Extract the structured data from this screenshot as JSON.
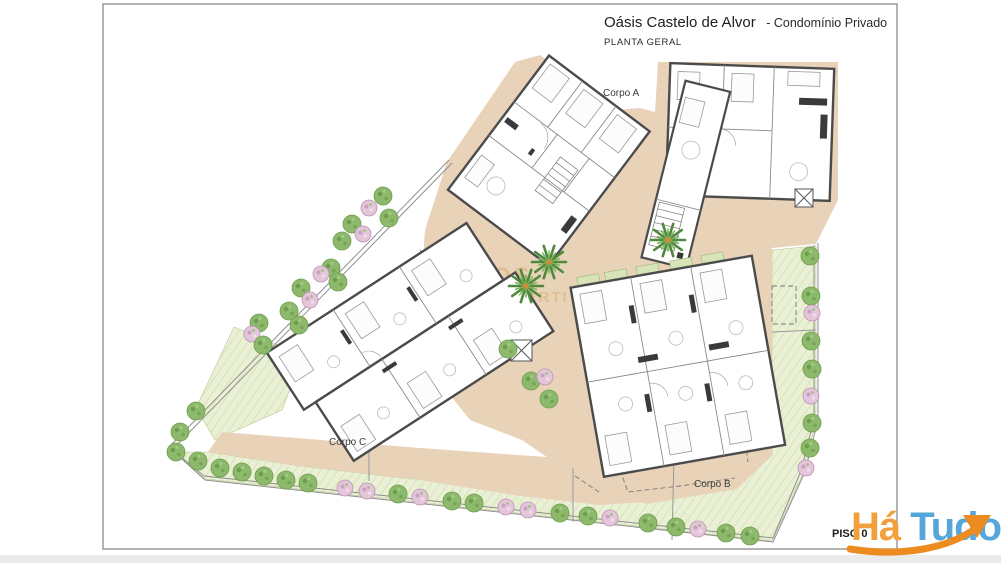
{
  "title_block": {
    "project_title": "Oásis Castelo de Alvor",
    "project_subtitle": "- Condomínio Privado",
    "drawing_name": "PLANTA GERAL"
  },
  "plan_labels": {
    "corpo_a": "Corpo A",
    "corpo_b": "Corpo B",
    "corpo_c": "Corpo C",
    "floor_label": "PISO 0"
  },
  "watermark": {
    "line1": "OS",
    "line2": "PROPERTI"
  },
  "logo": {
    "text_orange": "Há",
    "text_blue": "Tudo"
  },
  "colors": {
    "sheet_border": "#9a9a9a",
    "page_strip": "#ebebeb",
    "terrace": "#e8d3b9",
    "lawn": "#eaf0d5",
    "lawn_hatch": "#d3e0af",
    "tree_green": "#8cb96b",
    "tree_green_dark": "#6f9c4c",
    "shrub_pink": "#e4c6da",
    "shrub_pink_dark": "#c9a0c0",
    "palm_green": "#4e8a3c",
    "palm_center": "#cf8a3a",
    "wall": "#4b4b4b",
    "interior_line": "#8a8a8a",
    "boundary": "#8f8f8f",
    "watermark": "#d89a55",
    "logo_orange": "#F2A03E",
    "logo_blue": "#55A6DB",
    "logo_arrow": "#EC8B20"
  }
}
